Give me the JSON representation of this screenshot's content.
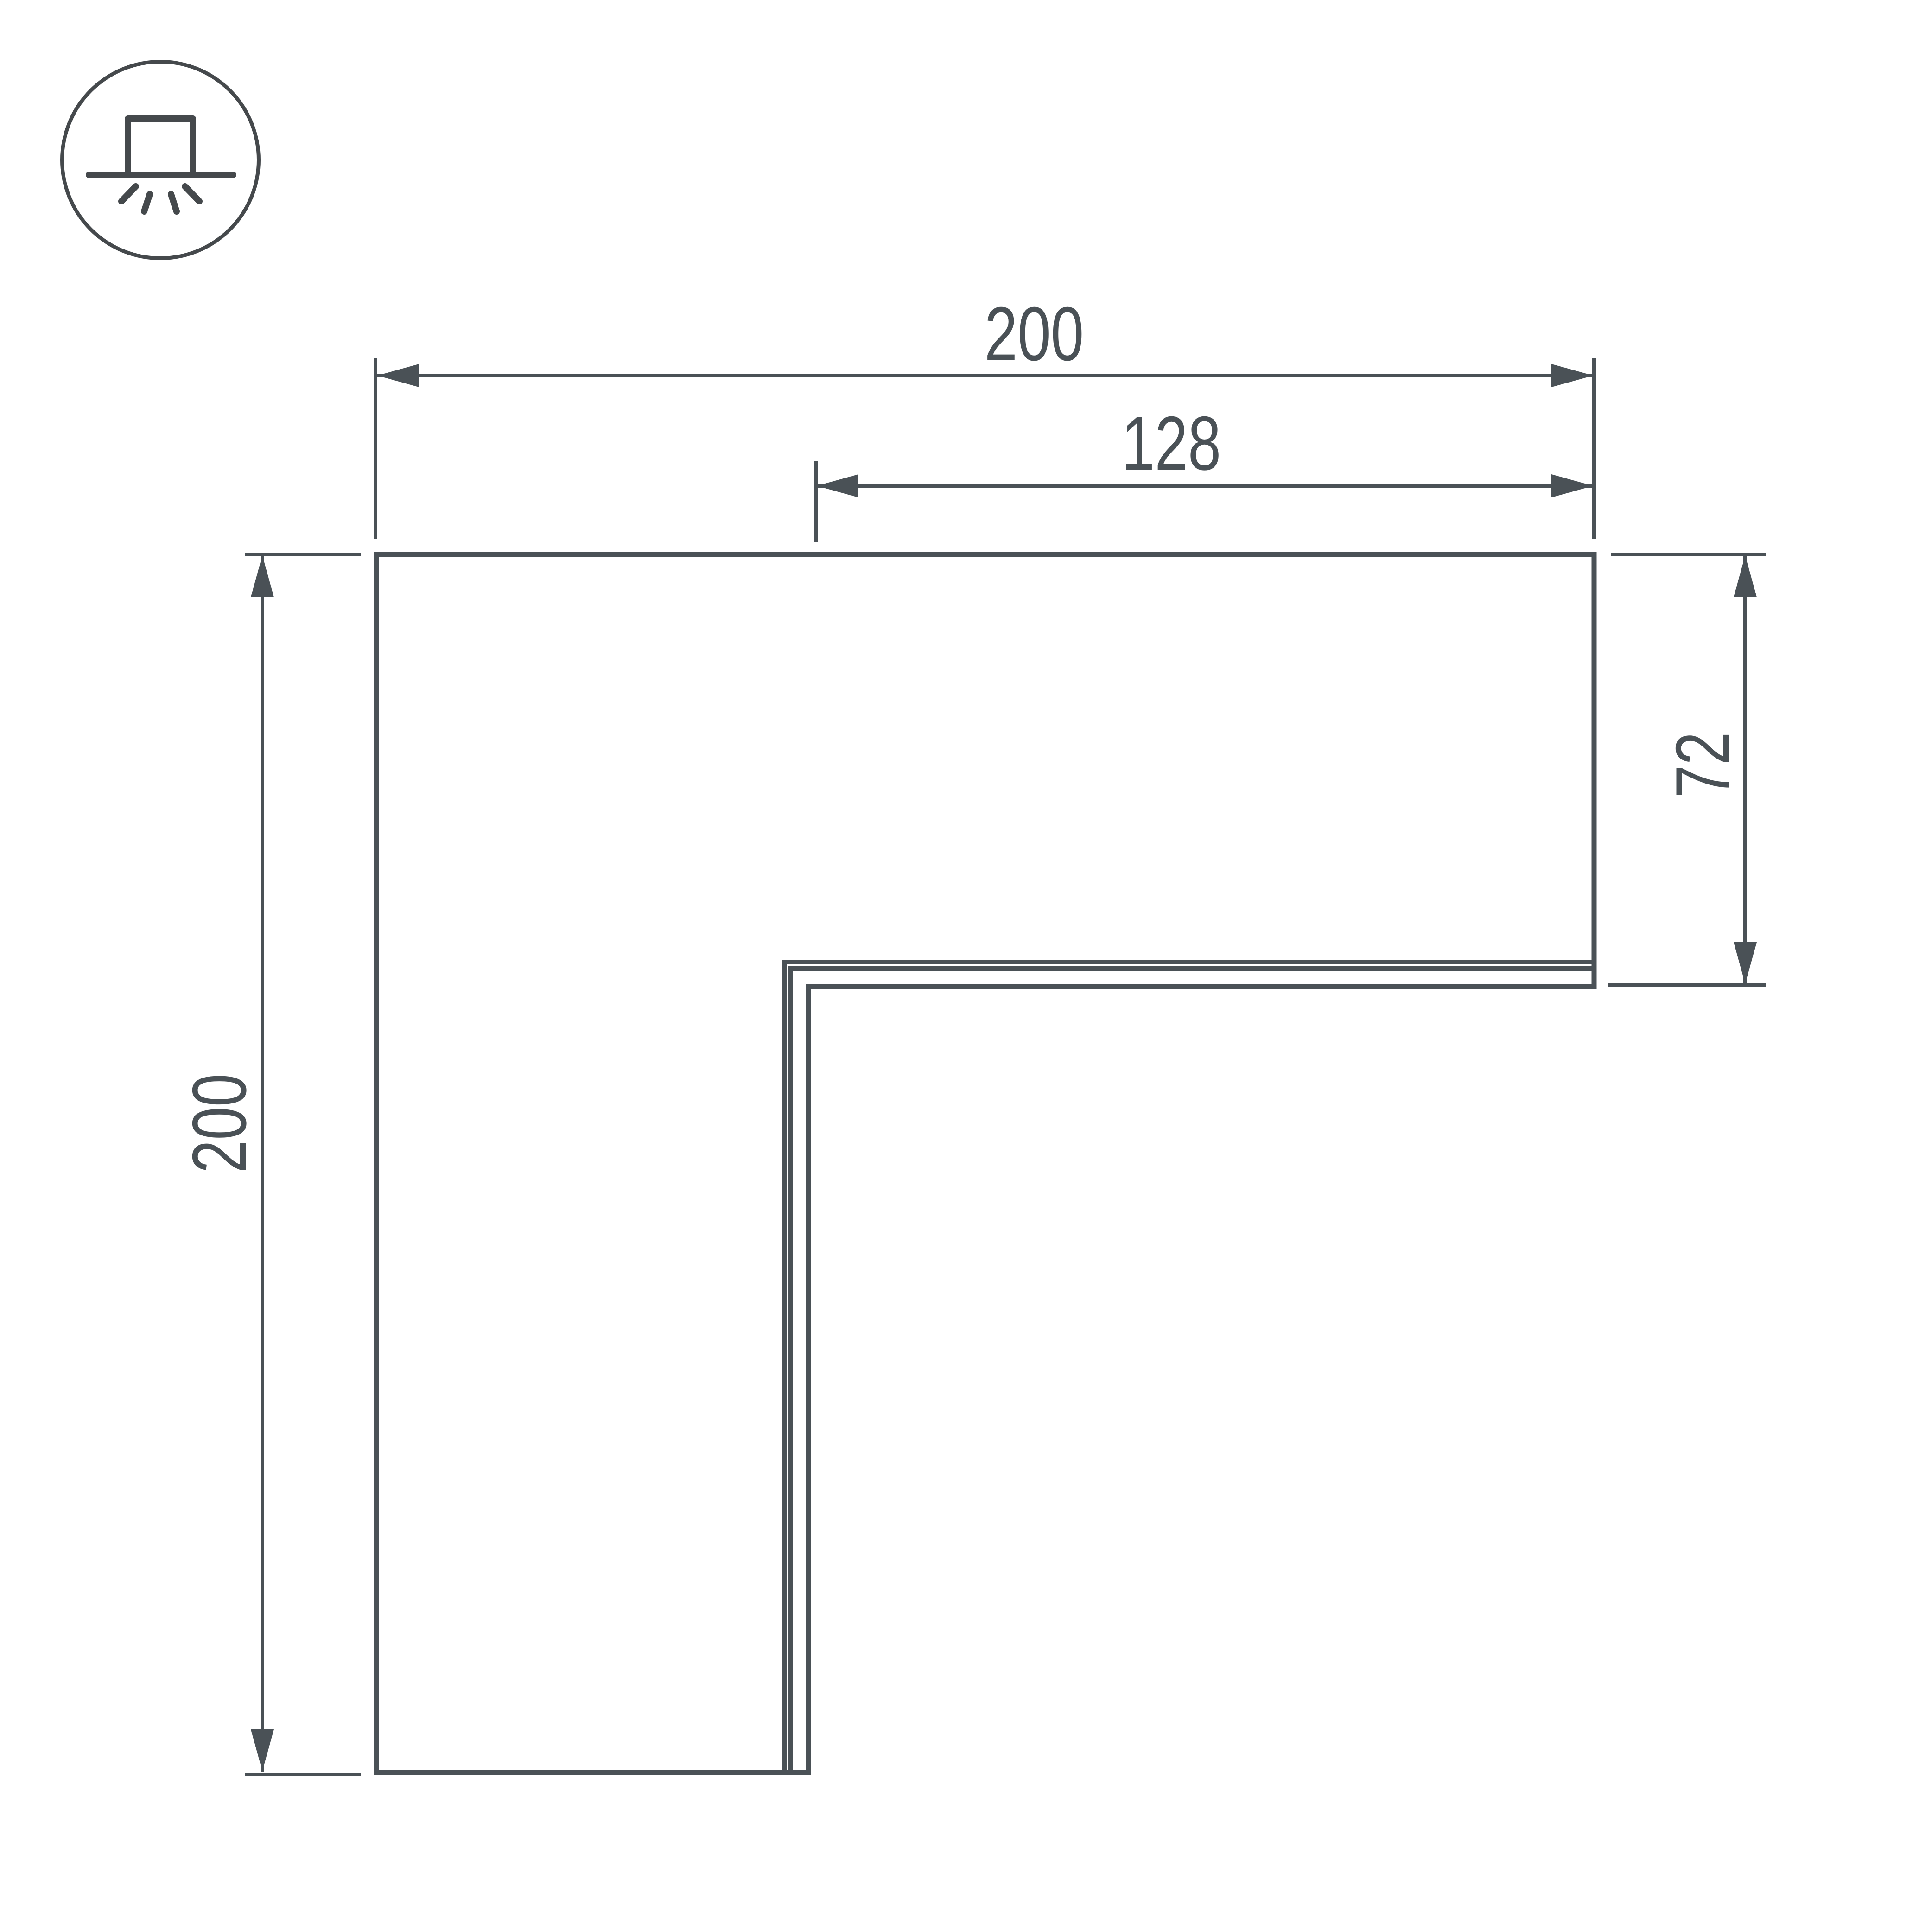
{
  "colors": {
    "line": "#4a5156",
    "icon": "#45494c",
    "background": "#ffffff"
  },
  "icon": {
    "name": "surface-mounted-light-icon",
    "meaning": "surface / ceiling mounted luminaire emitting light downward"
  },
  "drawing": {
    "type": "dimensioned-technical-drawing",
    "subject": "L-shaped corner profile, top view",
    "dimensions": {
      "overall_width": {
        "value": "200",
        "orientation": "horizontal",
        "position": "top"
      },
      "partial_width": {
        "value": "128",
        "orientation": "horizontal",
        "position": "top-inner"
      },
      "arm_height": {
        "value": "72",
        "orientation": "vertical",
        "position": "right"
      },
      "overall_height": {
        "value": "200",
        "orientation": "vertical",
        "position": "left"
      }
    }
  }
}
